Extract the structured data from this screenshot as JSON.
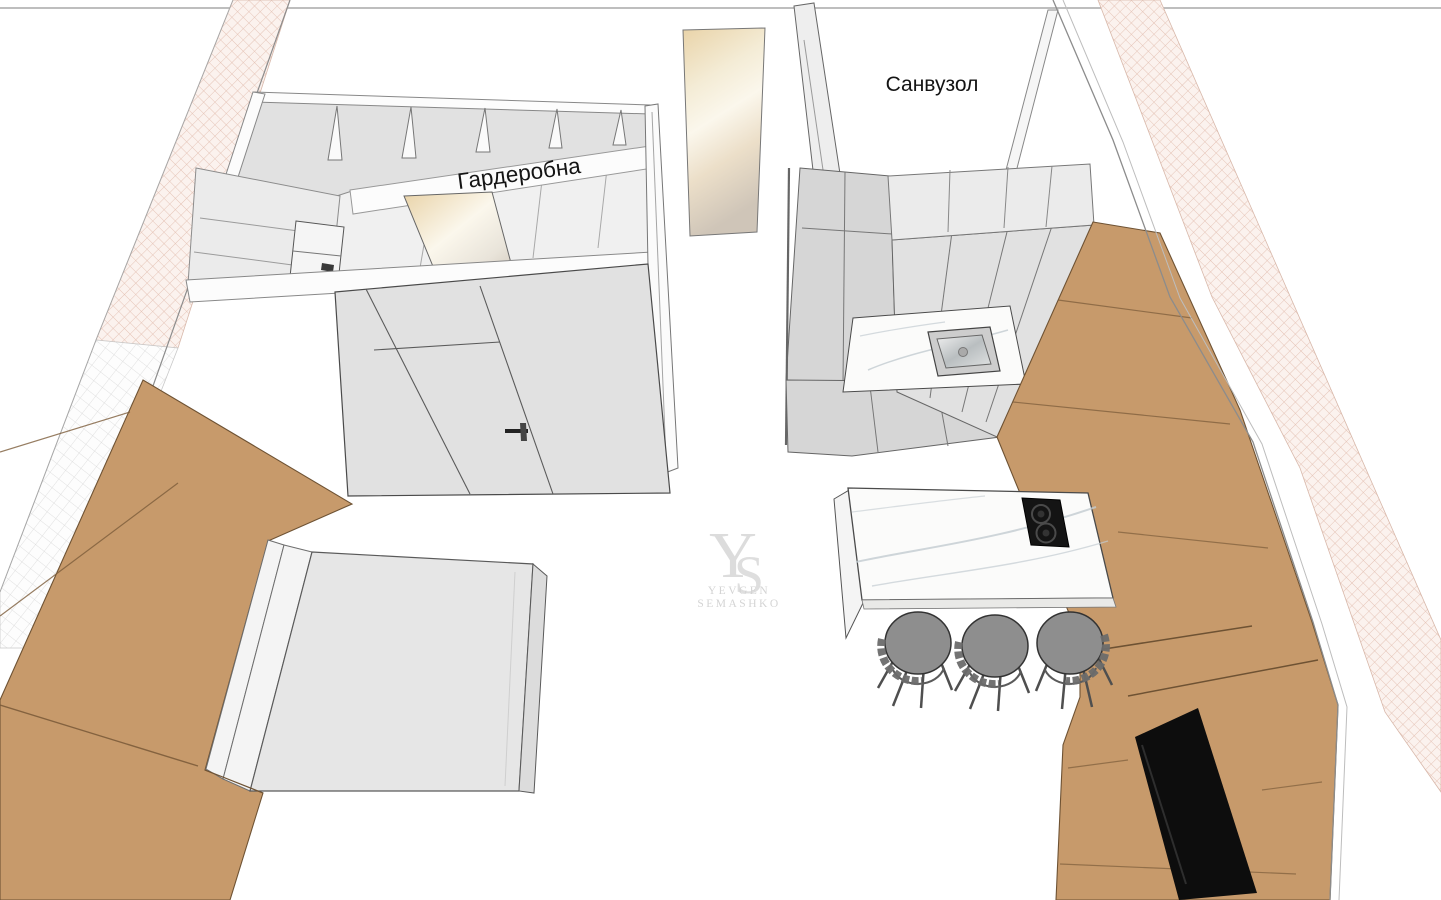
{
  "scene": {
    "type": "3d-interior-render",
    "rooms": {
      "wardrobe_label": "Гардеробна",
      "bathroom_label": "Санвузол"
    },
    "watermark": {
      "monogram_y": "Y",
      "monogram_s": "S",
      "line1": "YEVGEN",
      "line2": "SEMASHKO"
    },
    "palette": {
      "bg": "#ffffff",
      "frame_line": "#a8a8a8",
      "wall_hatch": "#e3bfb1",
      "hatch_bg": "#fbf2ee",
      "tile_grid": "#d9d9d9",
      "tile_bg": "#fdfdfd",
      "wood": "#c79a6b",
      "wood_edge": "#6e5233",
      "wood_seam": "#7d5d3b",
      "cabinet_light": "#ebebeb",
      "cabinet_face": "#e1e1e1",
      "cabinet_shade": "#d6d6d6",
      "floor_inner": "#f0f0f0",
      "wall_white": "#fcfcfc",
      "outline": "#4a4a4a",
      "outline_soft": "#8c8c8c",
      "marble": "#fbfbfa",
      "marble_vein": "#c3ccd1",
      "steel_rim": "#cdcdcd",
      "cooktop": "#141414",
      "burner_ring": "#4a4a4a",
      "tv": "#0d0d0d",
      "tv_edge": "#2e2e2e",
      "stool_seat": "#8e8e8e",
      "stool_frame": "#4f4f4f",
      "stool_back": "#6b6b6b",
      "mattress": "#e6e6e6",
      "mattress_side": "#dcdcdc",
      "bed_frame": "#f4f4f4",
      "mirror_warm": "#e9d3a8",
      "mirror_light": "#fbf7ec",
      "mirror_cool": "#cfc5b8",
      "label": "#141414",
      "watermark": "#d4d4d4"
    }
  }
}
